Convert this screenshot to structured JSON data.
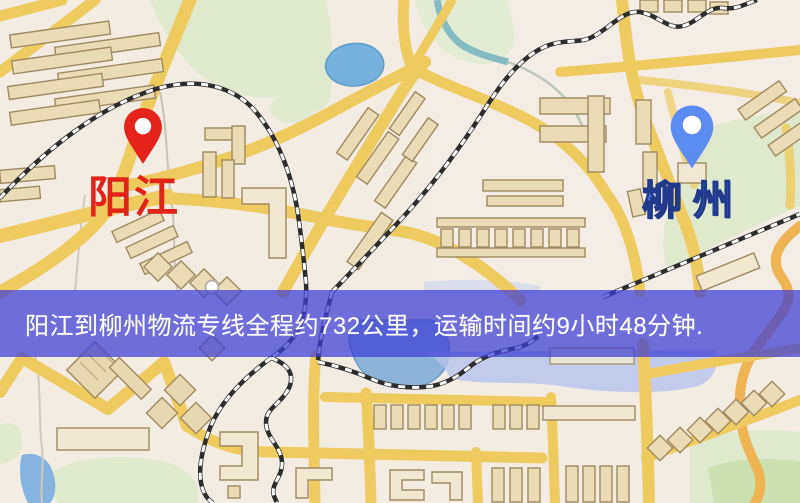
{
  "map": {
    "origin": {
      "name": "阳江",
      "pin_icon": "red-map-pin",
      "pin_color": "#e5231b",
      "label_color": "#e22418"
    },
    "destination": {
      "name": "柳州",
      "pin_icon": "blue-map-pin",
      "pin_color": "#5b8cf2",
      "label_color": "#4a7cee"
    },
    "info_banner": {
      "text": "阳江到柳州物流专线全程约732公里，运输时间约9小时48分钟.",
      "distance_km": "732",
      "transport_time": "9小时48分钟",
      "background_color": "#3e3ed6",
      "text_color": "#ffffff"
    }
  }
}
